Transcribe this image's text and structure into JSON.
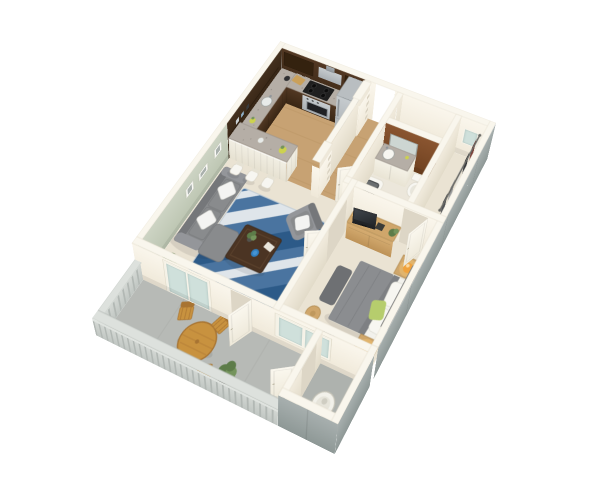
{
  "canvas": {
    "width": 600,
    "height": 495,
    "background": "#ffffff"
  },
  "scene": {
    "type": "3d-isometric-floor-plan",
    "subject": "one-bedroom one-bath apartment with balcony",
    "rooms": [
      {
        "name": "kitchen",
        "items": [
          "dark-upper-cabinets",
          "l-shaped-granite-counter",
          "stove-cooktop",
          "range-hood",
          "stainless-refrigerator",
          "breakfast-bar",
          "bar-stools-x3",
          "pantry-shelf-pillars",
          "wood-floor"
        ]
      },
      {
        "name": "living-room",
        "items": [
          "gray-sofa",
          "white-throw-pillows",
          "chaise-ottoman",
          "gray-armchair",
          "blue-area-rug",
          "dark-wood-coffee-table",
          "corner-potted-plant",
          "wall-picture-frames-x3",
          "sage-green-accent-wall"
        ]
      },
      {
        "name": "entry-hallway",
        "items": [
          "front-door-open"
        ]
      },
      {
        "name": "bathroom",
        "items": [
          "brown-accent-wall-with-mirror",
          "vanity-round-sink",
          "toilet",
          "bathtub"
        ]
      },
      {
        "name": "walk-in-closet",
        "items": [
          "hanging-rod",
          "hanging-clothes"
        ]
      },
      {
        "name": "bedroom",
        "items": [
          "bed-gray-duvet",
          "white-pillows",
          "green-accent-pillow",
          "headboard",
          "nightstands-x2",
          "orange-table-lamps-x2",
          "tv-console",
          "flat-tv",
          "foot-bench",
          "round-stool",
          "gray-pouf",
          "sliding-glass-windows"
        ]
      },
      {
        "name": "balcony",
        "items": [
          "round-wood-table",
          "folding-wood-chairs-x3",
          "potted-plant",
          "gray-railing",
          "sliding-glass-door"
        ]
      },
      {
        "name": "utility-closet",
        "items": [
          "water-heater"
        ]
      }
    ]
  },
  "palette": {
    "bg": "#ffffff",
    "carpet": "#eae3d3",
    "wood-floor": "#c7a273",
    "bath-floor": "#ece7db",
    "balcony-floor": "#b7bab6",
    "balcony-floor2": "#aeb2ae",
    "wall-top": "#f9f6ed",
    "wall-gap": "#ddd6c6",
    "green-wall": "#c6cebc",
    "ext-gray": "#9ba4a3",
    "dark-wood": "#46301f",
    "granite": "#b5aea6",
    "granite-dot": "#857e77",
    "steel": "#b9bec1",
    "brown-wall": "#7c4a28",
    "mirror": "#cdd6d2",
    "glass": "#cfe0db",
    "door-white": "#f7f3e9",
    "railing-stripe": "#b2b8b4",
    "railing-top": "#dde1dd",
    "sofa": "#898b8d",
    "sofa-dark": "#75777a",
    "sofa-arm": "#94969a",
    "pillow": "#f4f4f2",
    "rug-base": "#4a74a0",
    "rug-dark": "#2c5a88",
    "rug-light": "#dfe5ea",
    "table-wood": "#4b3423",
    "oak": "#cfa66b",
    "oak-dark": "#b08a50",
    "balcony-wood": "#c8923f",
    "balcony-wood-dark": "#a87432",
    "bed-white": "#f2f1ec",
    "bed-gray": "#8b8d90",
    "headboard": "#6e7073",
    "green-pillow": "#b6cd6d",
    "lamp": "#f0a23c",
    "lamp-glow": "#f7c66e",
    "plant": "#5d7c49",
    "plant-light": "#74945c",
    "pot": "#52524c",
    "fixture": "#f7f6f1",
    "tub-interior": "#4e5153",
    "water-heater": "#f2f1ea",
    "clothes-1": "#7a3b33",
    "clothes-2": "#2f3136",
    "clothes-3": "#e8e6df",
    "clothes-4": "#9a9c9e",
    "clothes-5": "#4a4d52"
  }
}
